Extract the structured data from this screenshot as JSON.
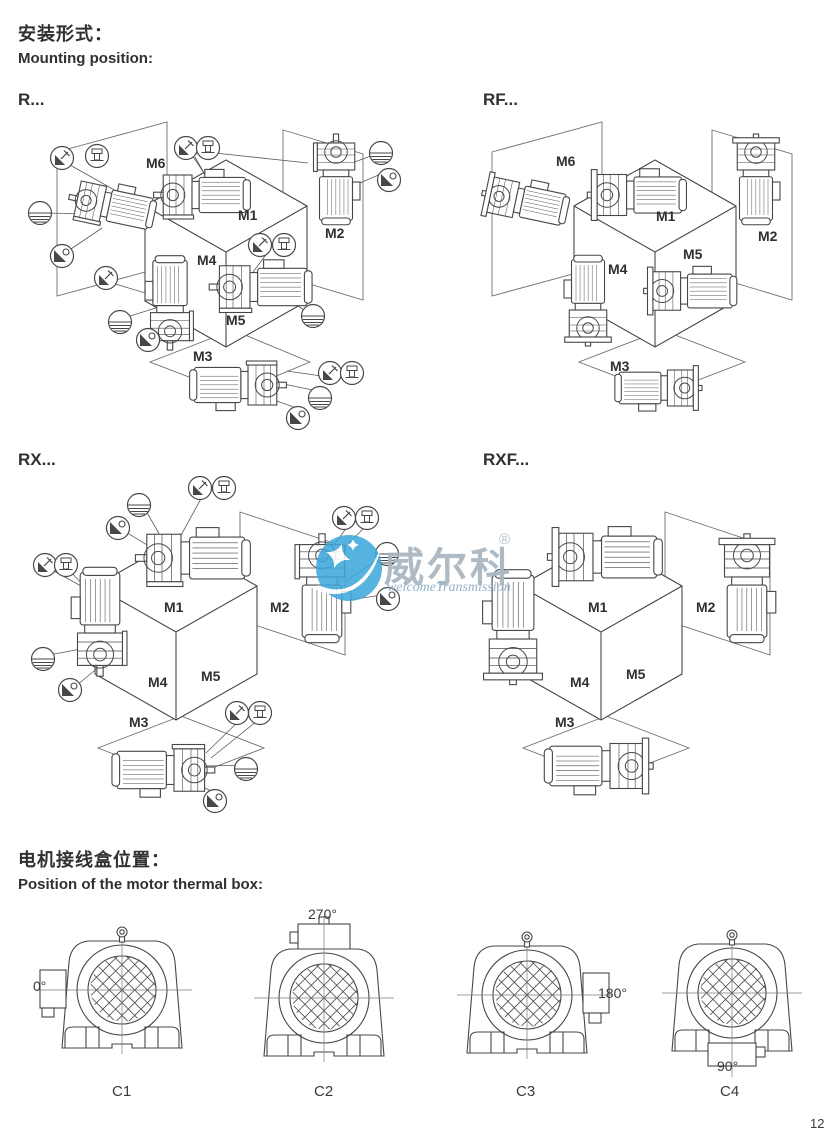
{
  "header": {
    "title_zh": "安装形式：",
    "title_en": "Mounting position:"
  },
  "panels": [
    {
      "id": "r",
      "label": "R...",
      "positions": {
        "m1": "M1",
        "m2": "M2",
        "m3": "M3",
        "m4": "M4",
        "m5": "M5",
        "m6": "M6"
      }
    },
    {
      "id": "rf",
      "label": "RF...",
      "positions": {
        "m1": "M1",
        "m2": "M2",
        "m3": "M3",
        "m4": "M4",
        "m5": "M5",
        "m6": "M6"
      }
    },
    {
      "id": "rx",
      "label": "RX...",
      "positions": {
        "m1": "M1",
        "m2": "M2",
        "m3": "M3",
        "m4": "M4",
        "m5": "M5"
      }
    },
    {
      "id": "rxf",
      "label": "RXF...",
      "positions": {
        "m1": "M1",
        "m2": "M2",
        "m3": "M3",
        "m4": "M4",
        "m5": "M5"
      }
    }
  ],
  "symbols": [
    "vent-plug-icon",
    "breather-plug-icon",
    "oil-level-plug-icon",
    "oil-drain-plug-icon"
  ],
  "thermal_box": {
    "title_zh": "电机接线盒位置：",
    "title_en": "Position of the motor thermal box:",
    "variants": [
      {
        "label": "C1",
        "angle": "0°"
      },
      {
        "label": "C2",
        "angle": "270°"
      },
      {
        "label": "C3",
        "angle": "180°"
      },
      {
        "label": "C4",
        "angle": "90°"
      }
    ]
  },
  "watermark": {
    "brand_zh": "威尔科",
    "registered": "®",
    "brand_en": "welcomeTransmission",
    "logo_blue": "#3fa8da"
  },
  "page_number": "12",
  "colors": {
    "line": "#474747",
    "plane_line": "#6f6f6f"
  }
}
